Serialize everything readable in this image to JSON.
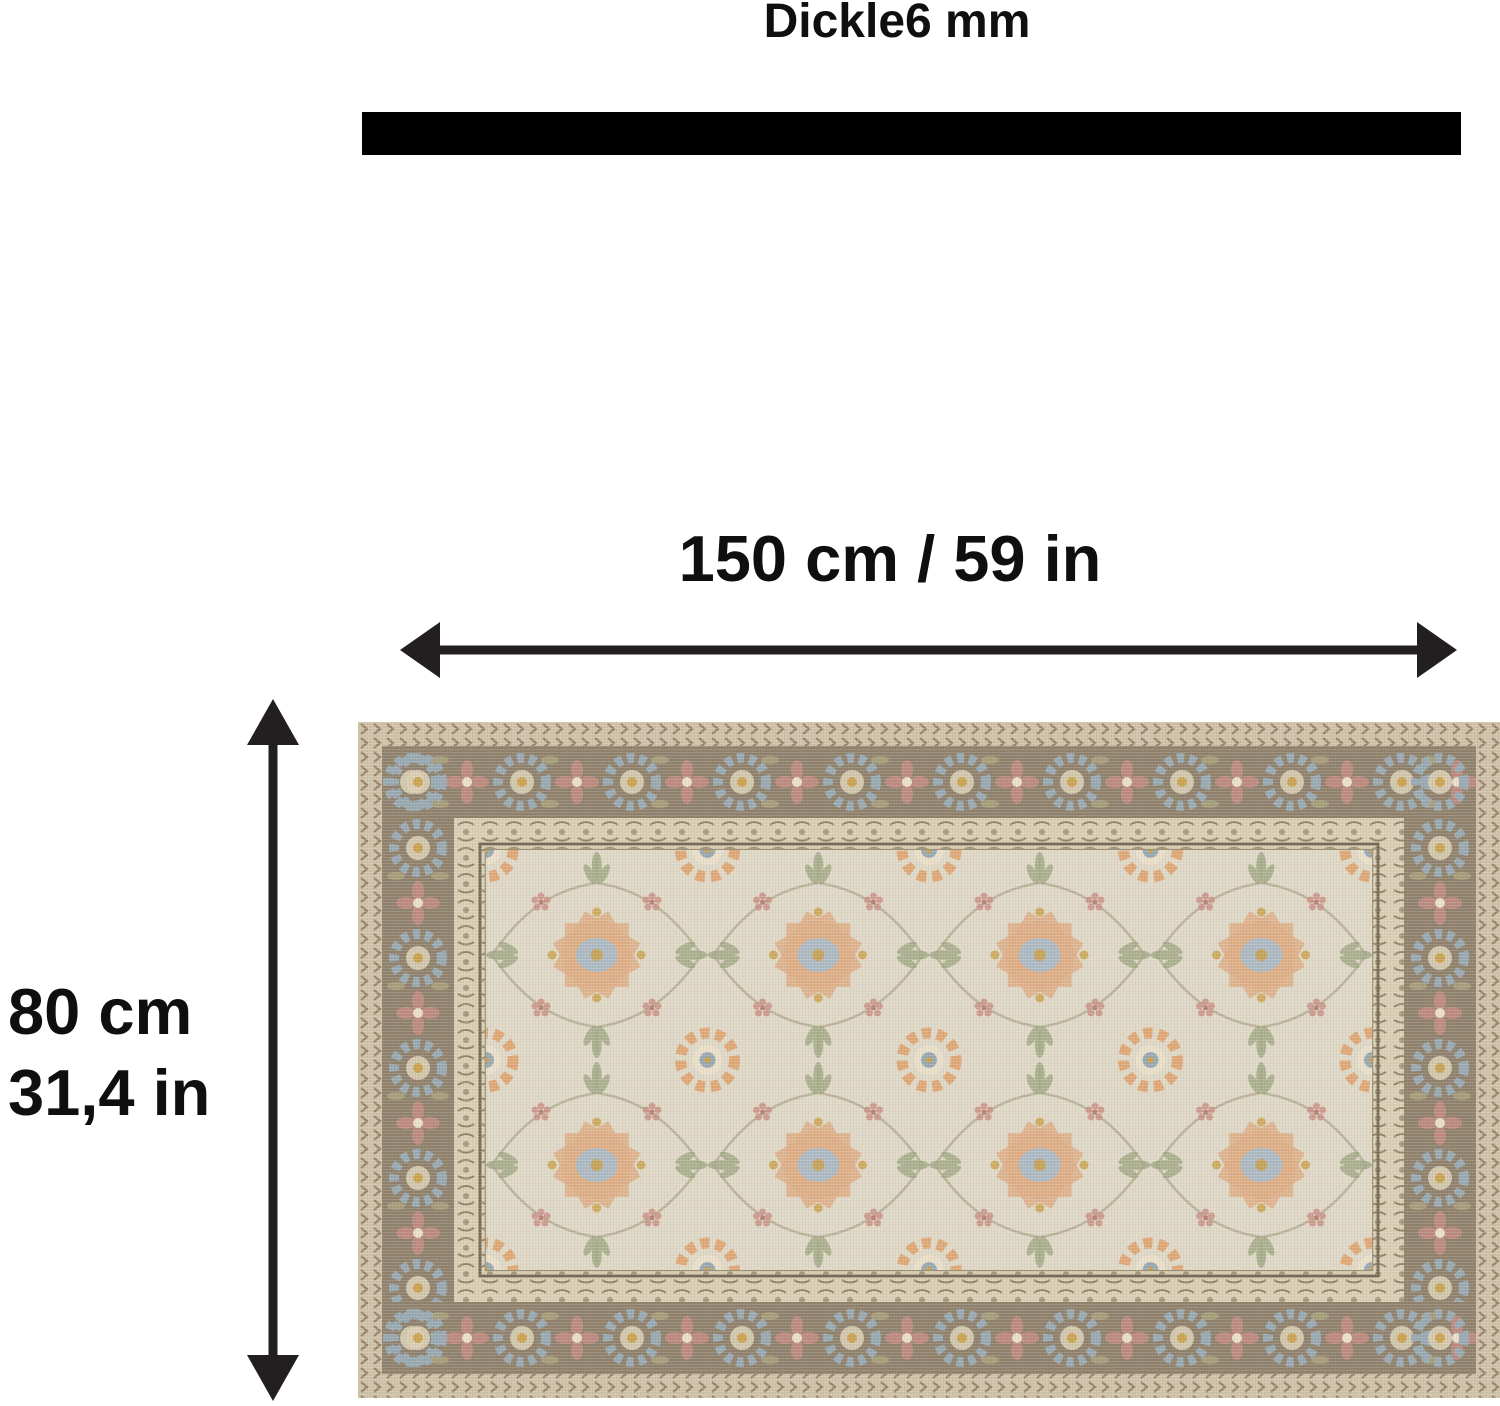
{
  "title": {
    "text": "Dickle6 mm"
  },
  "dimensions": {
    "width_label": "150 cm / 59 in",
    "height_label_line1": "80 cm",
    "height_label_line2": "31,4 in"
  },
  "colors": {
    "text": "#0f0f0f",
    "bar": "#000000",
    "arrow": "#231f20",
    "rug-outer": "#cdbfa4",
    "rug-chevron": "#8a7157",
    "rug-border": "#8a7b64",
    "rug-border-blue": "#93a4ae",
    "rug-border-rose": "#b98379",
    "rug-olive": "#a39a74",
    "rug-guard": "#d8ccb0",
    "rug-guard-motif": "#8f7e61",
    "rug-frame": "#6f624d",
    "rug-frame-light": "#9b8c6d",
    "rug-field": "#ded6c4",
    "rug-cream": "#e9ddc6",
    "rug-accent-orange": "#dda36f",
    "rug-accent-peach": "#dcab80",
    "rug-accent-blue": "#a9b6c0",
    "rug-accent-sage": "#9aa37c",
    "rug-accent-gold": "#c79a3d",
    "rug-accent-pink": "#c8897f",
    "rug-vine": "#95906f"
  }
}
